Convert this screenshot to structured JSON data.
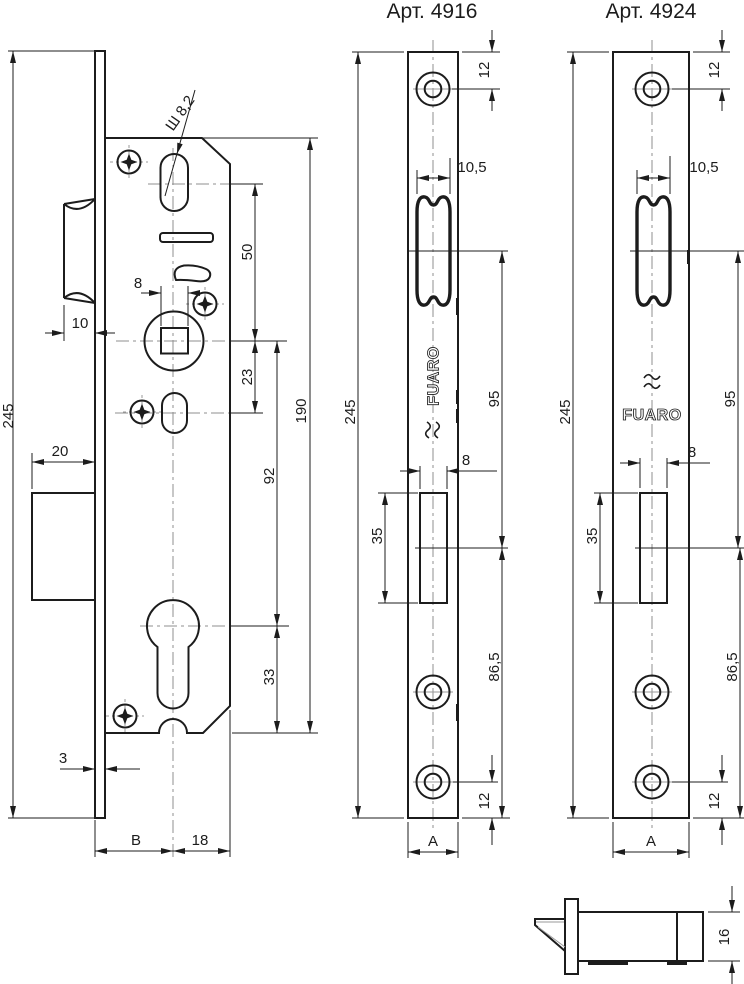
{
  "titles": {
    "strike_4916": "Арт. 4916",
    "strike_4924": "Арт. 4924"
  },
  "brand": {
    "name": "FUARO"
  },
  "lock_body": {
    "overall_height": "245",
    "latch_protrusion": "10",
    "deadbolt_protrusion": "20",
    "spindle_square_width": "8",
    "latch_to_spindle": "50",
    "spindle_to_handle_hole": "23",
    "spindle_to_cylinder": "92",
    "case_height": "190",
    "cylinder_to_bottom": "33",
    "faceplate_thickness": "3",
    "backset": "B",
    "spindle_to_case_back": "18",
    "shaft_note": "Ш 8,2"
  },
  "strike_4916": {
    "top_hole_offset": "12",
    "latch_opening_width": "10,5",
    "overall_height": "245",
    "latch_to_bolt_distance": "95",
    "bolt_opening_width": "8",
    "bolt_opening_height": "35",
    "bolt_to_bottom": "86,5",
    "bottom_hole_offset": "12",
    "plate_width": "A"
  },
  "strike_4924": {
    "top_hole_offset": "12",
    "latch_opening_width": "10,5",
    "overall_height": "245",
    "latch_to_bolt_distance": "95",
    "bolt_opening_width": "8",
    "bolt_opening_height": "35",
    "bolt_to_bottom": "86,5",
    "bottom_hole_offset": "12",
    "plate_width": "A"
  },
  "side_view": {
    "body_height": "16"
  },
  "colors": {
    "line": "#1c1c1c",
    "centerline": "#8f8f8f",
    "background": "#ffffff"
  }
}
